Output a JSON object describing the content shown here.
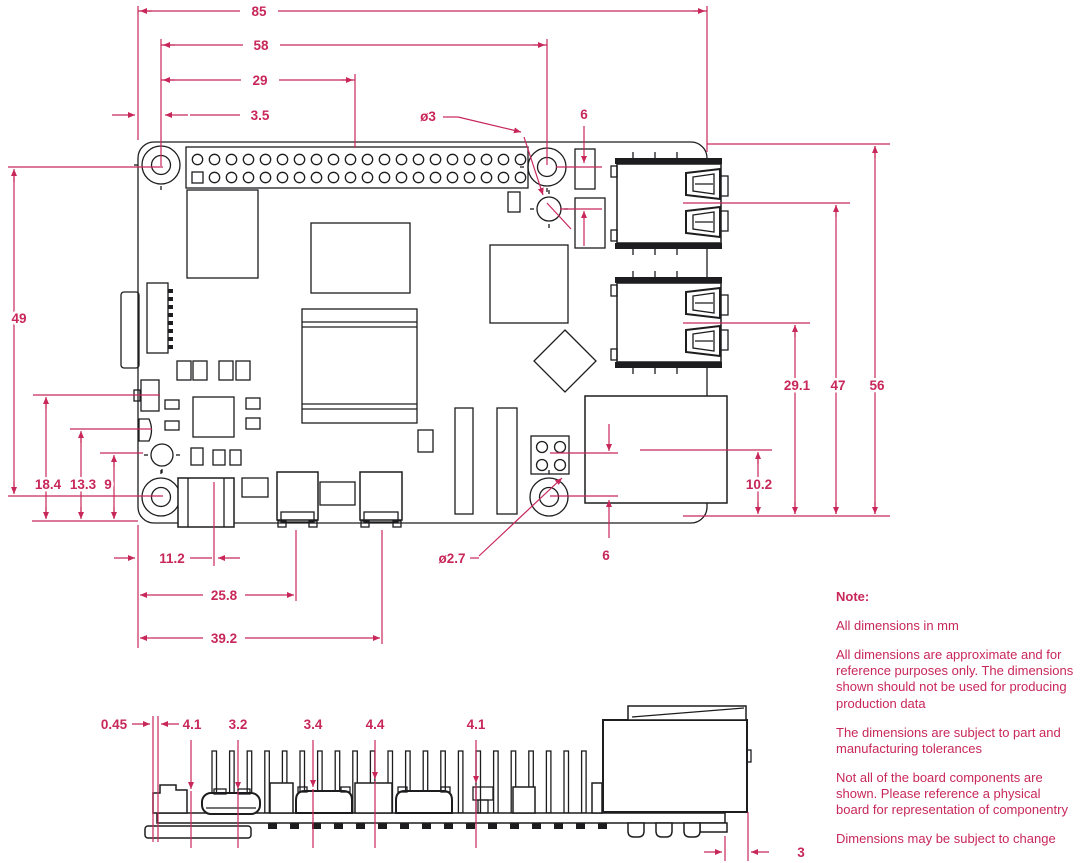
{
  "title": "Raspberry Pi board mechanical dimension drawing",
  "colors": {
    "accent": "#c8275a",
    "line": "#1d1d1f",
    "background": "#ffffff"
  },
  "dims": {
    "board_width": "85",
    "hole_span_x": "58",
    "gpio_offset": "29",
    "edge_to_hole": "3.5",
    "top_hole_dia": "ø3",
    "top_hole_gap": "6",
    "hole_span_y": "49",
    "left_comp1": "18.4",
    "left_comp2": "13.3",
    "left_comp3": "9",
    "usb_lower_center": "29.1",
    "usb_upper_center": "47",
    "board_height": "56",
    "eth_center": "10.2",
    "bottom_hole_gap": "6",
    "usbc_center": "11.2",
    "hdmi0_center": "25.8",
    "hdmi1_center": "39.2",
    "bottom_hole_dia": "ø2.7",
    "side_gap": "0.45",
    "side_h1": "4.1",
    "side_h2": "3.2",
    "side_h3": "3.4",
    "side_h4": "4.4",
    "side_h5": "4.1",
    "side_overhang": "3"
  },
  "note": {
    "title": "Note:",
    "items": [
      "All dimensions in mm",
      "All dimensions are approximate and for reference purposes only. The dimensions shown should not be used for producing production data",
      "The dimensions are subject to part and manufacturing tolerances",
      "Not all of the board components are shown. Please reference a physical board for representation of componentry",
      "Dimensions may be subject to change"
    ]
  }
}
